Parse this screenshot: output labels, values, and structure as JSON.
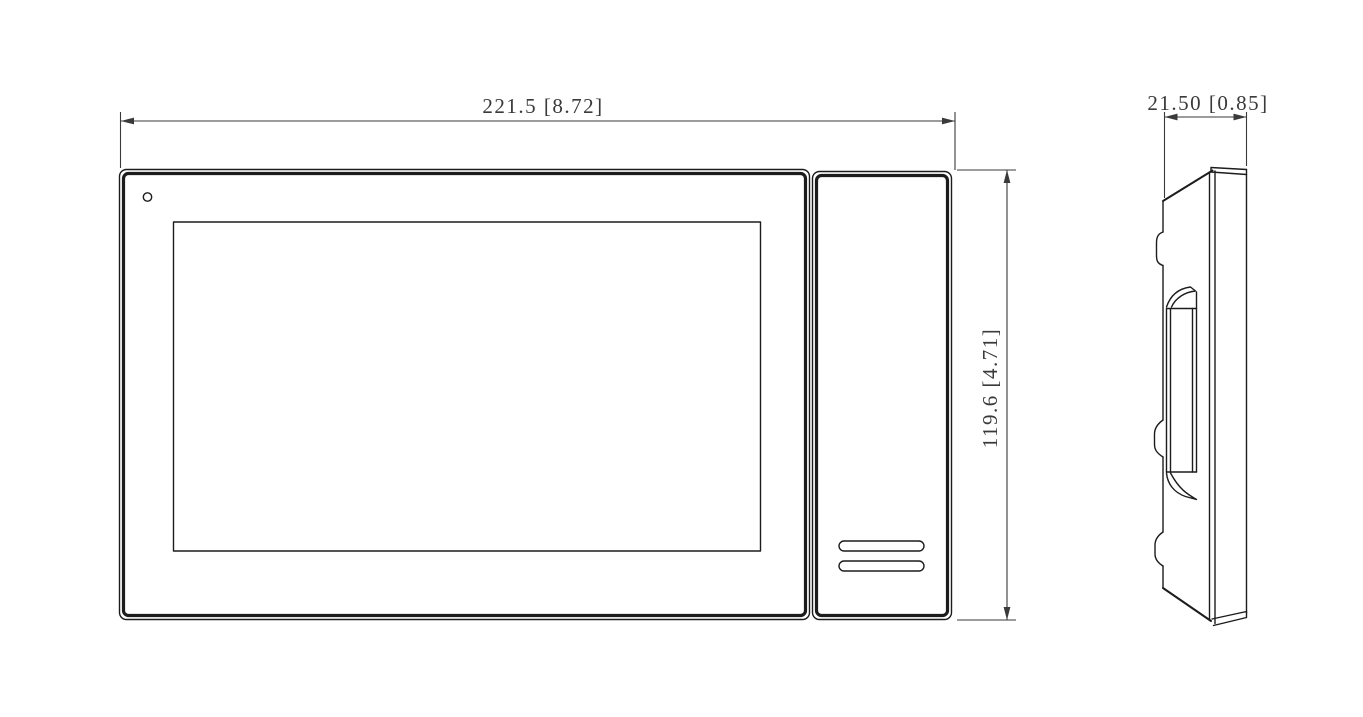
{
  "drawing": {
    "type": "technical-dimension-drawing",
    "subject": "video-intercom-indoor-monitor",
    "colors": {
      "background": "#ffffff",
      "line": "#1c1c1c",
      "dimension": "#3a3a3a"
    },
    "dimensions": {
      "width": {
        "mm": "221.5",
        "inch": "8.72",
        "label": "221.5 [8.72]"
      },
      "height": {
        "mm": "119.6",
        "inch": "4.71",
        "label": "119.6 [4.71]"
      },
      "depth": {
        "mm": "21.50",
        "inch": "0.85",
        "label": "21.50 [0.85]"
      }
    },
    "views": {
      "front": "front view (screen, indicator hole, handset panel with speaker slots)",
      "side": "side profile view (mounting clips and hanging recess)"
    }
  }
}
